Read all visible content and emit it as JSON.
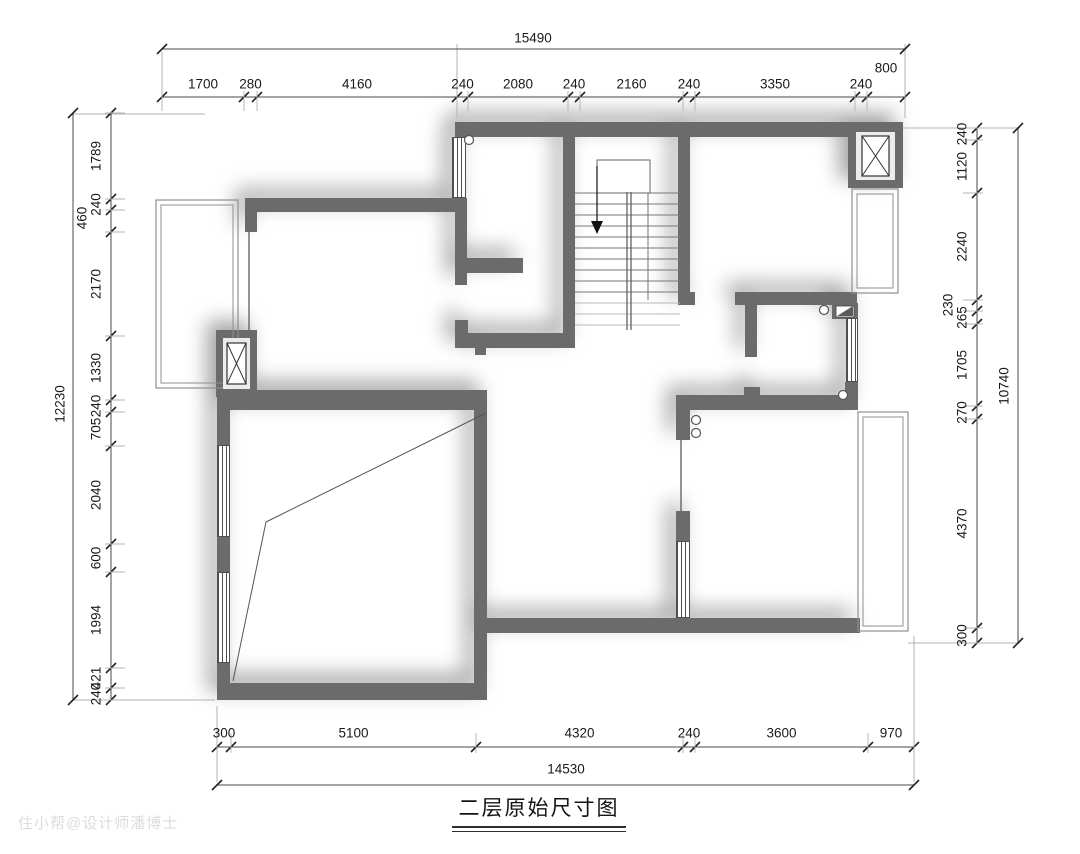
{
  "title": "二层原始尺寸图",
  "watermark": "住小帮@设计师潘博士",
  "colors": {
    "wall": "#6b6b6b",
    "dim_line": "#4a4a4a",
    "tick": "#222222",
    "ext": "#b3b3b3",
    "thin": "#8f8f8f",
    "stair_line": "#777777",
    "stair_light": "#b8b8b8",
    "text": "#1a1a1a",
    "glass": "#666666",
    "watermark": "#dcdcdc"
  },
  "dims": {
    "top": {
      "orient": "h",
      "chain": 97,
      "labels_off": -13,
      "ext": [
        -6,
        14
      ],
      "total_line": 49,
      "total": "15490",
      "total_pos": [
        533,
        38
      ],
      "boundaries": [
        162,
        244,
        257,
        457,
        468,
        568,
        580,
        683,
        695,
        855,
        867,
        905
      ],
      "segments": [
        "1700",
        "280",
        "4160",
        "240",
        "2080",
        "240",
        "2160",
        "240",
        "3350",
        "240",
        "800"
      ],
      "raised": {
        "10": [
          886,
          68
        ]
      }
    },
    "bottom": {
      "orient": "h",
      "chain": 747,
      "labels_off": -14,
      "ext": [
        -14,
        6
      ],
      "total_line": 785,
      "total": "14530",
      "total_pos": [
        566,
        769
      ],
      "boundaries": [
        217,
        231,
        476,
        683,
        695,
        868,
        914
      ],
      "segments": [
        "300",
        "5100",
        "4320",
        "240",
        "3600",
        "970"
      ],
      "raised": {}
    },
    "left": {
      "orient": "v",
      "chain": 111,
      "labels_off": -15,
      "ext": [
        -6,
        14
      ],
      "total_line": 73,
      "total": "12230",
      "total_pos": [
        60,
        404
      ],
      "boundaries": [
        113,
        199,
        210,
        232,
        336,
        400,
        412,
        446,
        544,
        572,
        668,
        688,
        700
      ],
      "segments": [
        "1789",
        "240",
        "460",
        "2170",
        "1330",
        "240",
        "705",
        "2040",
        "600",
        "1994",
        "421",
        "240"
      ],
      "raised": {
        "2": [
          82,
          218
        ]
      }
    },
    "right": {
      "orient": "v",
      "chain": 977,
      "labels_off": -15,
      "ext": [
        -14,
        6
      ],
      "total_line": 1018,
      "total": "10740",
      "total_pos": [
        1004,
        386
      ],
      "boundaries": [
        128,
        140,
        193,
        300,
        311,
        324,
        406,
        419,
        628,
        643
      ],
      "segments": [
        "240",
        "1120",
        "2240",
        "230",
        "265",
        "1705",
        "270",
        "4370",
        "300"
      ],
      "raised": {
        "3": [
          948,
          305
        ]
      }
    }
  },
  "plan": {
    "walls": [
      [
        455,
        122,
        448,
        15
      ],
      [
        563,
        122,
        12,
        226
      ],
      [
        678,
        122,
        12,
        172
      ],
      [
        678,
        292,
        17,
        13
      ],
      [
        245,
        198,
        222,
        14
      ],
      [
        245,
        198,
        12,
        34
      ],
      [
        455,
        212,
        12,
        73
      ],
      [
        455,
        258,
        68,
        15
      ],
      [
        455,
        333,
        118,
        15
      ],
      [
        455,
        320,
        13,
        28
      ],
      [
        475,
        348,
        11,
        7
      ],
      [
        217,
        390,
        268,
        20
      ],
      [
        474,
        390,
        13,
        310
      ],
      [
        217,
        683,
        270,
        17
      ],
      [
        217,
        390,
        13,
        55
      ],
      [
        217,
        537,
        13,
        35
      ],
      [
        217,
        663,
        13,
        37
      ],
      [
        474,
        618,
        386,
        15
      ],
      [
        676,
        395,
        14,
        45
      ],
      [
        676,
        511,
        14,
        30
      ],
      [
        676,
        395,
        181,
        15
      ],
      [
        744,
        387,
        16,
        9
      ],
      [
        845,
        382,
        13,
        28
      ],
      [
        735,
        292,
        122,
        13
      ],
      [
        745,
        305,
        12,
        52
      ],
      [
        832,
        303,
        26,
        16
      ],
      [
        216,
        330,
        41,
        67
      ],
      [
        848,
        122,
        55,
        66
      ]
    ],
    "windows": [
      [
        452,
        137,
        14,
        61
      ],
      [
        217,
        445,
        13,
        92
      ],
      [
        217,
        572,
        13,
        91
      ],
      [
        676,
        541,
        14,
        77
      ],
      [
        846,
        318,
        12,
        64
      ]
    ],
    "shafts": [
      {
        "inner": [
          223,
          338,
          27,
          51
        ],
        "xbox": [
          227,
          343,
          19,
          41
        ]
      },
      {
        "inner": [
          856,
          132,
          39,
          48
        ],
        "xbox": [
          862,
          136,
          27,
          40
        ]
      }
    ],
    "door": {
      "inner": [
        836,
        306,
        18,
        11
      ],
      "leaf": [
        [
          837,
          316
        ],
        [
          853,
          306
        ],
        [
          853,
          316
        ]
      ]
    },
    "balconies": [
      [
        156,
        200,
        82,
        188
      ],
      [
        852,
        189,
        46,
        104
      ],
      [
        858,
        412,
        50,
        219
      ]
    ],
    "glass": [
      [
        249,
        232,
        249,
        330
      ],
      [
        681,
        440,
        681,
        511
      ]
    ],
    "diagonals": [
      [
        486,
        413,
        266,
        522
      ],
      [
        266,
        522,
        233,
        681
      ]
    ],
    "circles": [
      [
        469,
        140
      ],
      [
        696,
        420
      ],
      [
        696,
        433
      ],
      [
        824,
        310
      ],
      [
        843,
        395
      ]
    ],
    "stair": {
      "x1": 575,
      "x2": 680,
      "treads": [
        193,
        204,
        215,
        226,
        237,
        248,
        259,
        270,
        281,
        292
      ],
      "treads_light": [
        303,
        314,
        325
      ],
      "rails": [
        [
          627,
          192,
          627,
          330
        ],
        [
          631,
          192,
          631,
          330
        ]
      ],
      "thin_v": [
        648,
        193,
        648,
        300
      ],
      "landing": [
        597,
        160,
        53,
        33
      ],
      "arrow_stem": [
        597,
        166,
        597,
        221
      ],
      "arrow_head": [
        [
          591,
          221
        ],
        [
          603,
          221
        ],
        [
          597,
          234
        ]
      ]
    },
    "ext_lines": [
      [
        73,
        114,
        205,
        114
      ],
      [
        73,
        700,
        215,
        700
      ],
      [
        162,
        52,
        162,
        108
      ],
      [
        905,
        44,
        905,
        118
      ],
      [
        903,
        128,
        1020,
        128
      ],
      [
        908,
        643,
        1020,
        643
      ],
      [
        217,
        706,
        217,
        782
      ],
      [
        914,
        636,
        914,
        782
      ],
      [
        457,
        44,
        457,
        118
      ]
    ]
  }
}
